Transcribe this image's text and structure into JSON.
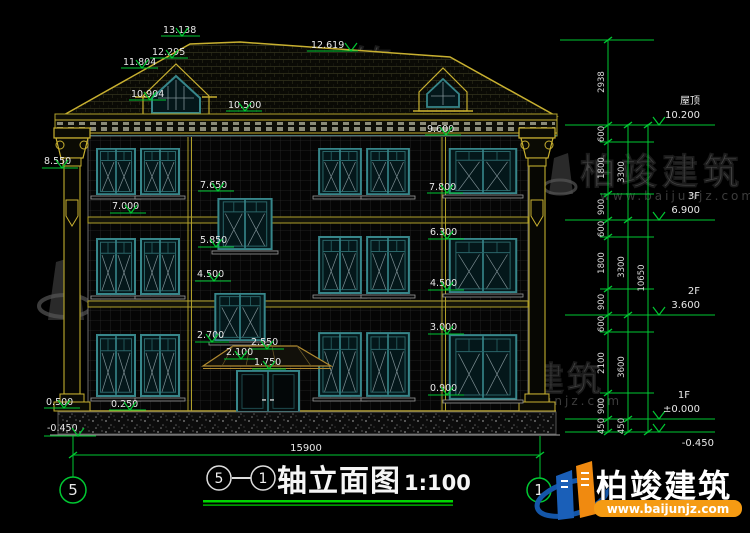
{
  "title": {
    "axis_a": "5",
    "dash": "—",
    "axis_b": "1",
    "name": "轴立面图",
    "scale": "1:100"
  },
  "axis_bubbles": {
    "left": "5",
    "right": "1"
  },
  "overall_width": "15900",
  "levels": {
    "roof_name": "屋顶",
    "roof": "10.200",
    "f3_name": "3F",
    "f3": "6.900",
    "f2_name": "2F",
    "f2": "3.600",
    "f1_name": "1F",
    "f1": "±0.000",
    "ground": "-0.450"
  },
  "dims_right": {
    "inner": [
      "2938",
      "600",
      "1800",
      "900",
      "600",
      "1800",
      "900",
      "600",
      "2100",
      "900",
      "450"
    ],
    "mid": [
      "3300",
      "3300",
      "3600",
      "450"
    ],
    "outer": "10650"
  },
  "marks": {
    "m13138": "13.138",
    "m12619": "12.619",
    "m12295": "12.295",
    "m11804": "11.804",
    "m10904": "10.904",
    "m10500": "10.500",
    "m9600": "9.600",
    "m8550": "8.550",
    "m7800": "7.800",
    "m7650": "7.650",
    "m7000": "7.000",
    "m6300": "6.300",
    "m5850": "5.850",
    "m4500mid": "4.500",
    "m4500right": "4.500",
    "m3000": "3.000",
    "m2700": "2.700",
    "m2550": "2.550",
    "m2100": "2.100",
    "m1750": "1.750",
    "m0900": "0.900",
    "m0500": "0.500",
    "m0250": "0.250",
    "m0450left": "-0.450"
  },
  "watermark": {
    "brand": "柏竣建筑",
    "url": "www.baijunjz.com"
  },
  "logo": {
    "brand": "柏竣建筑",
    "url": "www.baijunjz.com"
  },
  "colors": {
    "background": "#000000",
    "annotation_green": "#00c832",
    "trim_yellow": "#c8b030",
    "window_teal": "#37868a",
    "logo_blue": "#1a5fb8",
    "logo_orange": "#f59b13"
  }
}
